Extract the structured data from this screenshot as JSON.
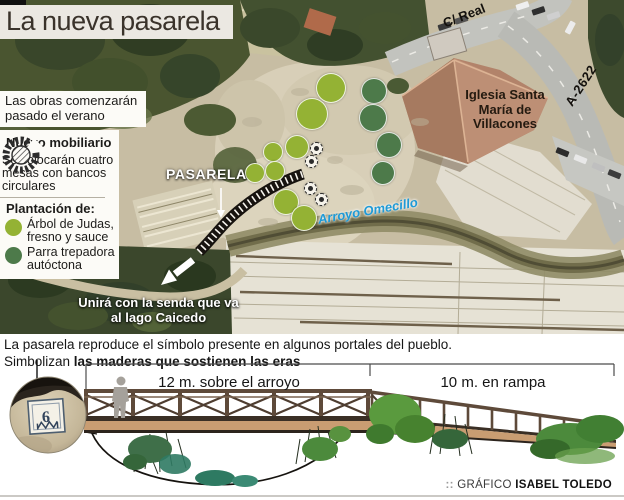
{
  "title": {
    "text": "La nueva pasarela"
  },
  "map": {
    "labels": {
      "street": "C/ Real",
      "road": "A-2622",
      "church_lines": [
        "Iglesia Santa",
        "María de",
        "Villacones"
      ],
      "pasarela": "PASARELA",
      "stream": "Arroyo Omecillo",
      "senda_lines": [
        "Unirá con la senda que va",
        "al lago Caicedo"
      ]
    },
    "callouts": {
      "obras": "Las obras comenzarán pasado el verano",
      "mobiliario_title": "Nuevo mobiliario",
      "mobiliario_text": "Se colocarán cuatro mesas con bancos circulares",
      "plantacion_title": "Plantación de:",
      "plantacion_items": [
        {
          "label": "Árbol de Judas, fresno y sauce",
          "color": "#94b234"
        },
        {
          "label": "Parra trepadora autóctona",
          "color": "#4d7a4a"
        }
      ]
    },
    "markers": {
      "light_trees": [
        [
          330,
          87,
          14
        ],
        [
          311,
          113,
          15
        ],
        [
          296,
          146,
          11
        ],
        [
          272,
          151,
          9
        ],
        [
          254,
          172,
          9
        ],
        [
          274,
          170,
          9
        ],
        [
          285,
          201,
          12
        ],
        [
          303,
          217,
          12
        ]
      ],
      "dark_trees": [
        [
          373,
          90,
          12
        ],
        [
          372,
          117,
          13
        ],
        [
          388,
          144,
          12
        ],
        [
          382,
          172,
          11
        ]
      ],
      "tables": [
        [
          316,
          148
        ],
        [
          311,
          161
        ],
        [
          310,
          188
        ],
        [
          321,
          199
        ]
      ]
    },
    "icons": {
      "mobiliario": "round-table-with-circular-bench-icon",
      "tables_on_map": "picnic-table-marker-icon",
      "pasarela_on_map": "footbridge-hatched-band",
      "senda_arrow": "white-direction-arrow"
    }
  },
  "bottom": {
    "para_line1": "La pasarela reproduce el símbolo presente en algunos portales del pueblo.",
    "para_line2_regular": "Simbolizan ",
    "para_line2_bold": "las maderas que sostienen las eras",
    "dim_left": "12 m. sobre el arroyo",
    "dim_right": "10 m. en rampa",
    "stone_number": "6",
    "credit_prefix": "::",
    "credit_label": "GRÁFICO",
    "credit_name": "ISABEL TOLEDO"
  },
  "colors": {
    "tree_light": "#94b234",
    "tree_dark": "#4d7a4a",
    "stream_label_blue": "#1f9ad6",
    "title_band": "#ebe8e2",
    "bridge_wood": "#5e4a3a",
    "bridge_deck": "#c99d72"
  }
}
